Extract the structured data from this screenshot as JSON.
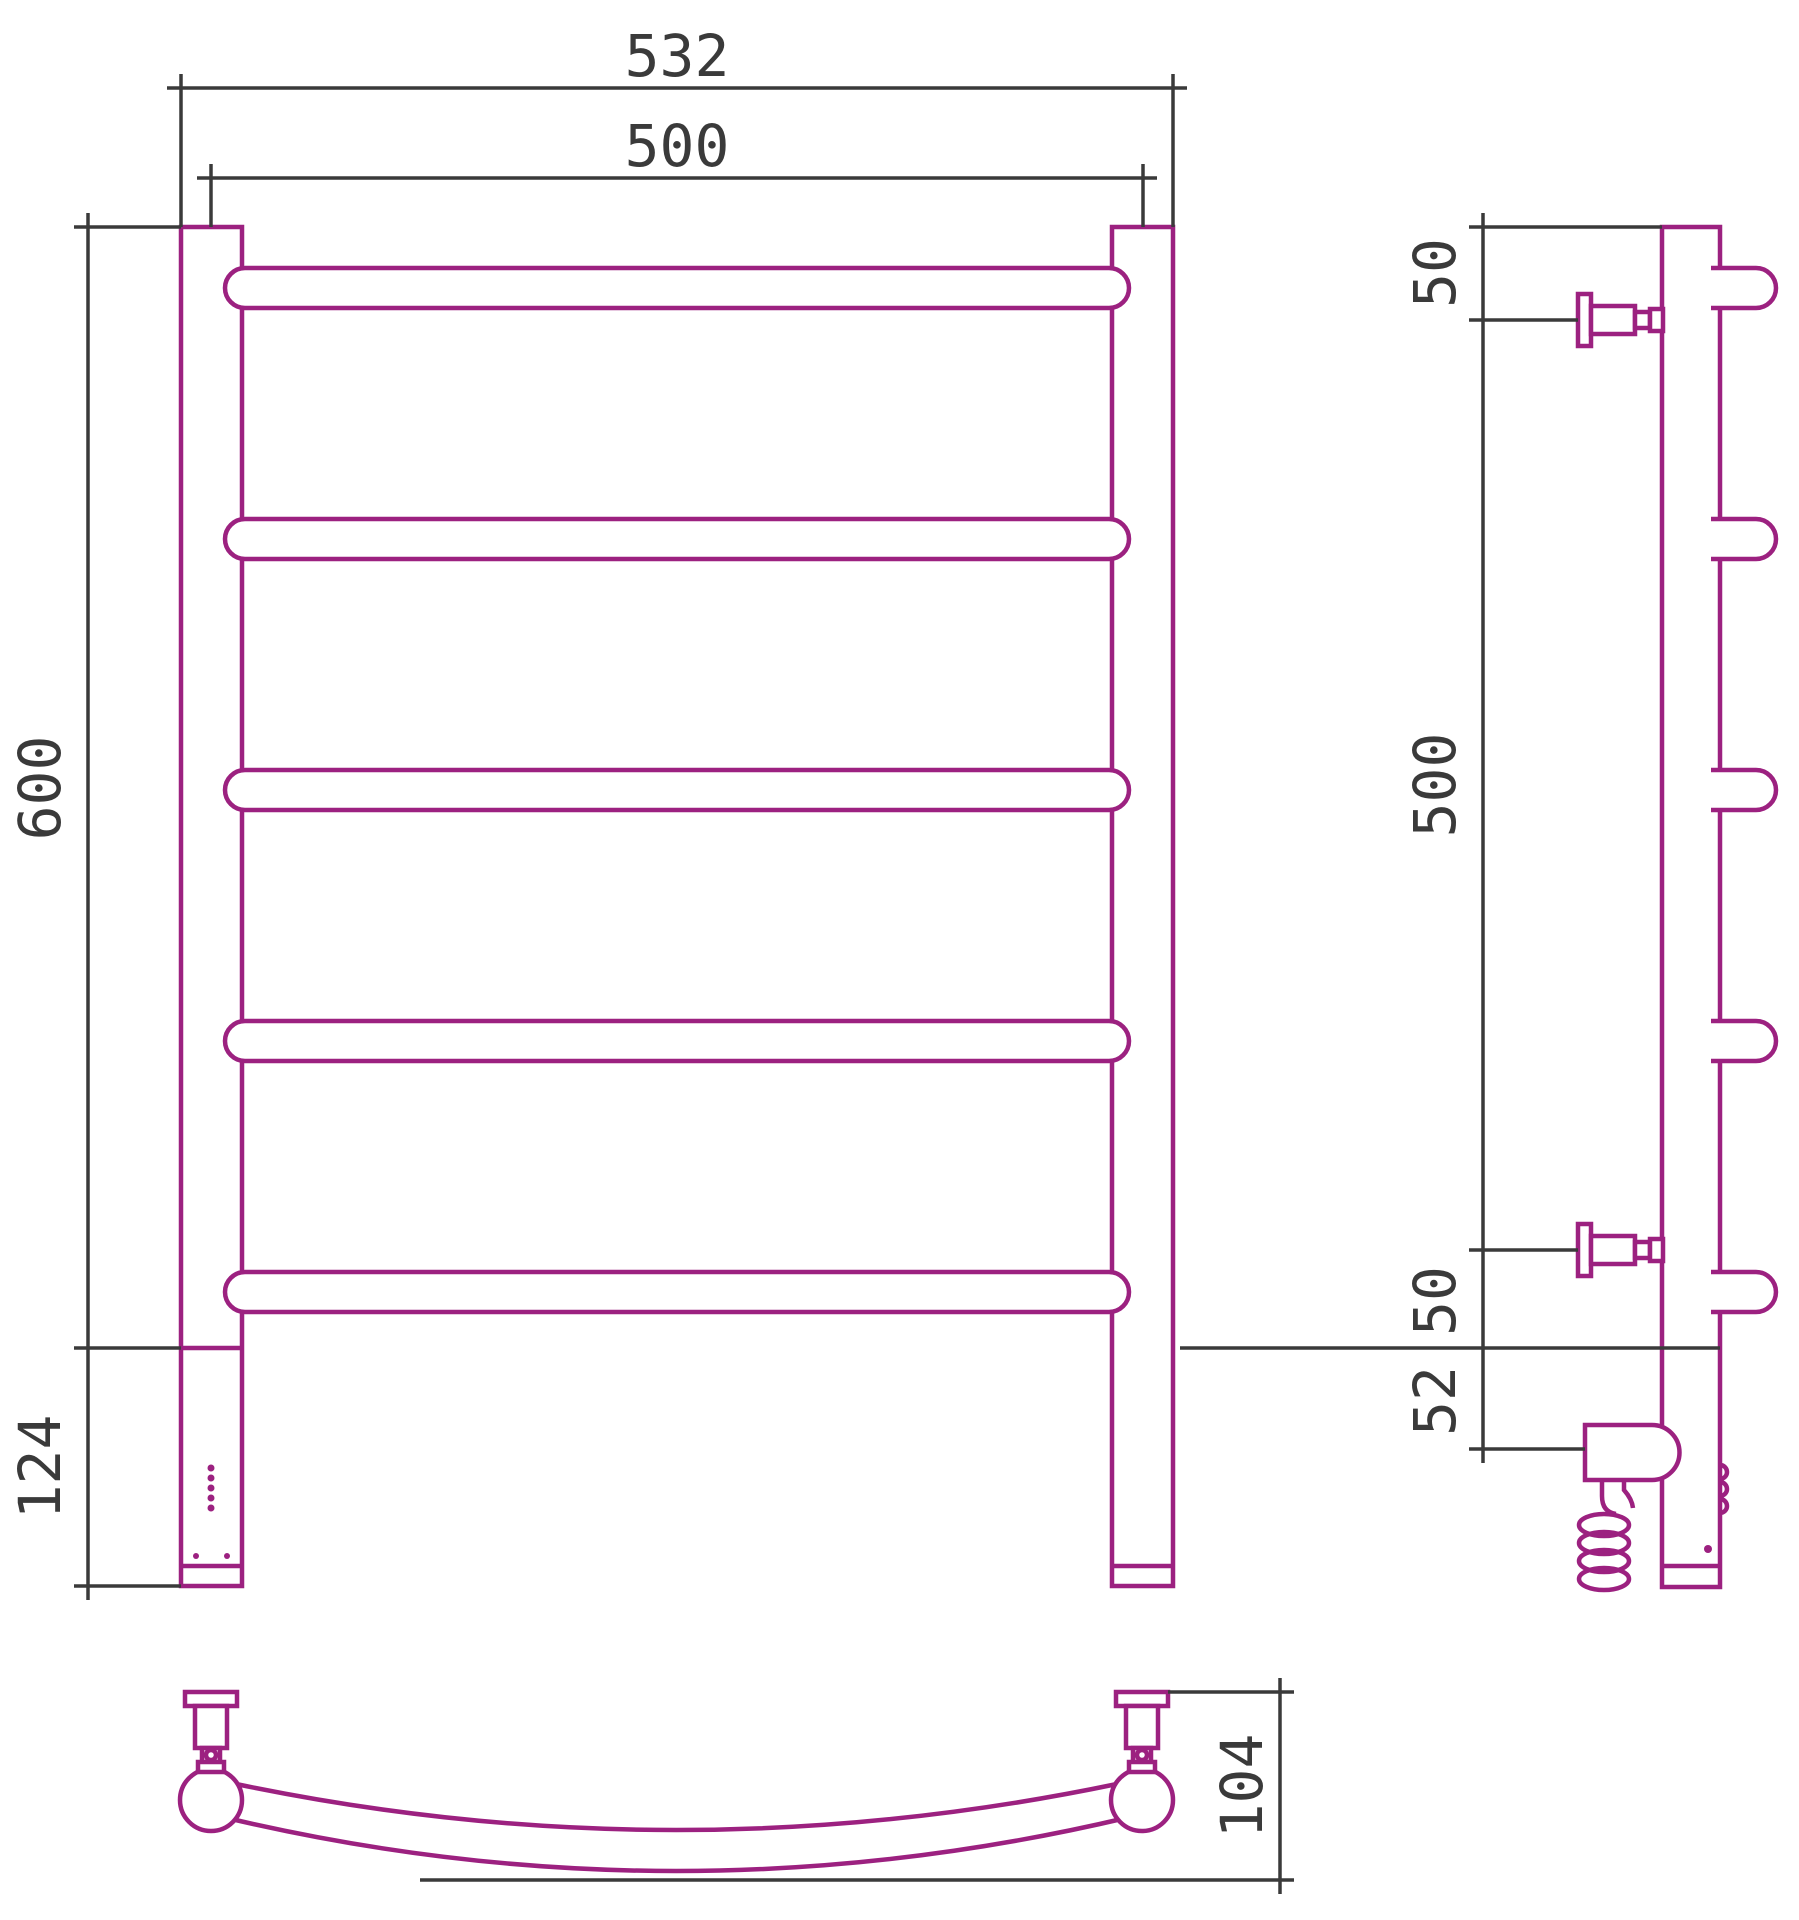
{
  "drawing": {
    "subject": "heated towel rail orthographic drawing",
    "bar_count": 5,
    "palette": {
      "outline": "#9c2180",
      "dimension": "#3a3a3a",
      "background": "#ffffff"
    },
    "views": {
      "front": {
        "name": "front-view",
        "dims": {
          "overall_width": "532",
          "bar_length": "500",
          "height": "600",
          "heater_section_height": "124"
        }
      },
      "side": {
        "name": "side-view",
        "dims": {
          "top_to_upper_bracket": "50",
          "bracket_spacing": "500",
          "lower_bracket_offset": "50",
          "heater_element_offset": "52"
        }
      },
      "top": {
        "name": "top-view",
        "dims": {
          "depth": "104"
        }
      }
    }
  }
}
